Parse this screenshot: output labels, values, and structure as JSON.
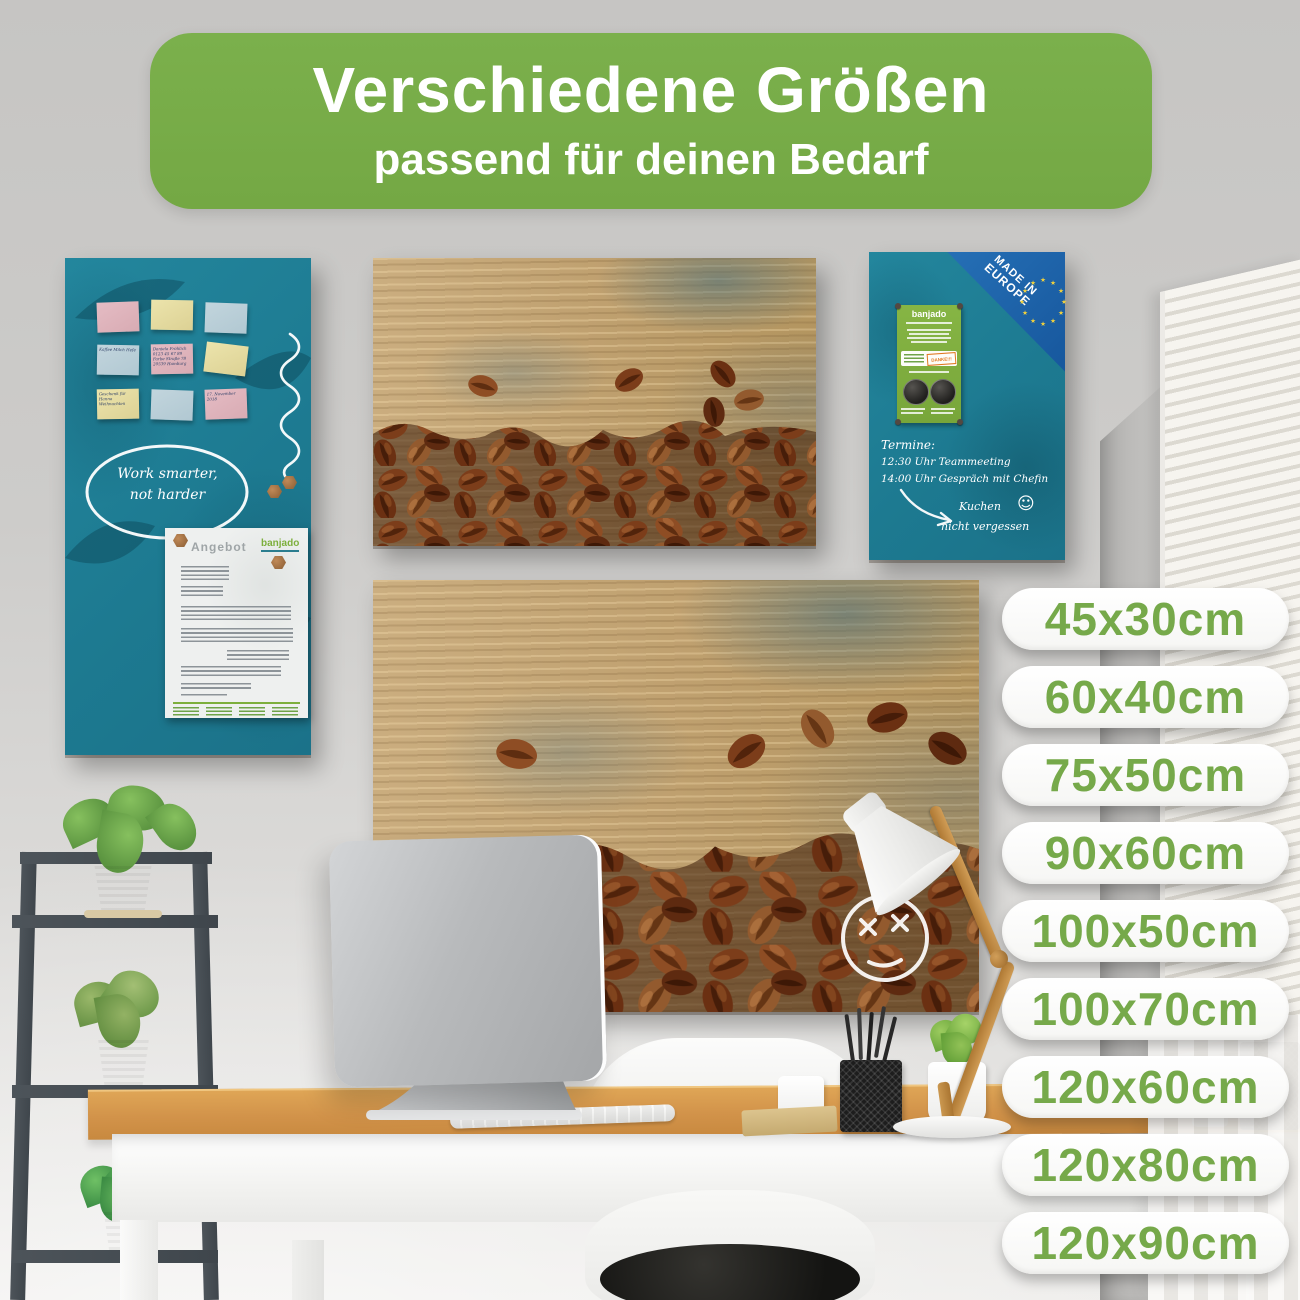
{
  "banner": {
    "title": "Verschiedene Größen",
    "subtitle": "passend für deinen Bedarf"
  },
  "sizes": {
    "items": [
      "45x30cm",
      "60x40cm",
      "75x50cm",
      "90x60cm",
      "100x50cm",
      "100x70cm",
      "120x60cm",
      "120x80cm",
      "120x90cm"
    ]
  },
  "left_board": {
    "speech_bubble_line1": "Work smarter,",
    "speech_bubble_line2": "not harder",
    "sticky_notes": [
      "",
      "",
      "",
      "Kaffee Milch Hefe",
      "Daniela Fröhlich 0123 45 67 89 Farbe Straße 78 20539 Hamburg",
      "",
      "Geschenk für Hanna Weihnachten",
      "",
      "17. November 2018"
    ],
    "document": {
      "title": "Angebot",
      "logo": "banjado"
    }
  },
  "right_board": {
    "made_in_line1": "MADE IN",
    "made_in_line2": "EUROPE",
    "flyer_logo": "banjado",
    "flyer_stamp": "DANKE!!!",
    "note_title": "Termine:",
    "note_line1": "12:30 Uhr Teammeeting",
    "note_line2": "14:00 Uhr Gespräch mit Chefin",
    "reminder_line1": "Kuchen",
    "reminder_line2": "nicht vergessen",
    "reminder_smiley": "☺"
  },
  "colors": {
    "banner_green": "#77ac48",
    "size_text_green": "#76a94a",
    "board_teal": "#1f7e95",
    "made_in_blue": "#1a67ad",
    "flyer_green": "#7fae3f"
  }
}
